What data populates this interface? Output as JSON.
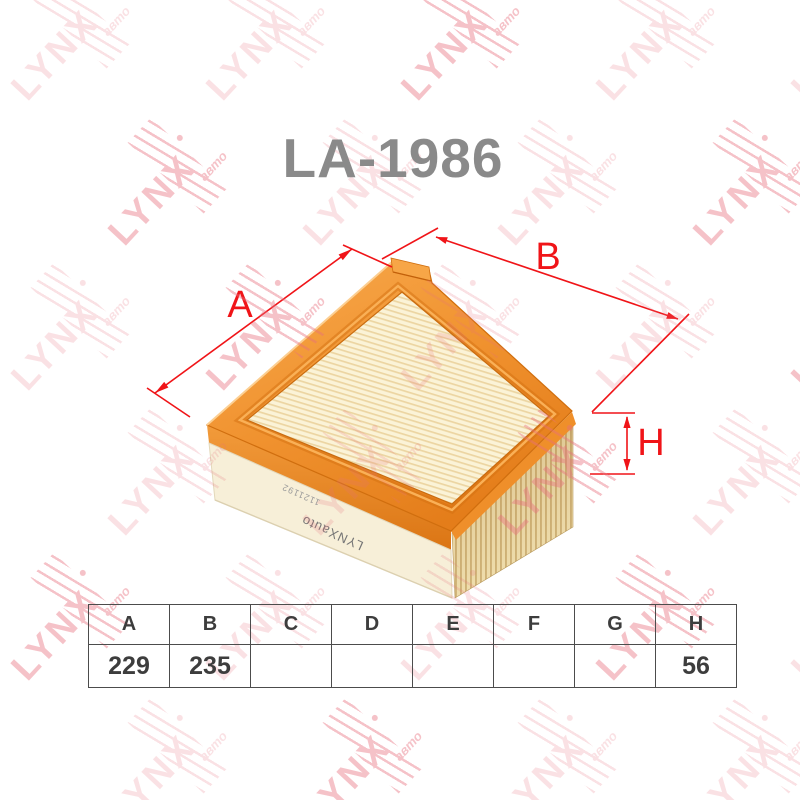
{
  "page": {
    "background": "#ffffff"
  },
  "title": {
    "text": "LA-1986",
    "color": "#8a8a8a"
  },
  "watermark": {
    "text": "LYNX",
    "sub": "авто",
    "color": "#e8707e"
  },
  "product": {
    "description": "engine air filter, orange frame with pleated paper media",
    "frame_color": "#f0922f",
    "media_color": "#fbf3d7",
    "stamp_brand": "LYNXauto",
    "stamp_code": "1121192"
  },
  "dimensions": {
    "color": "#f01418",
    "labels": {
      "a": "A",
      "b": "B",
      "h": "H"
    }
  },
  "table": {
    "headers": [
      "A",
      "B",
      "C",
      "D",
      "E",
      "F",
      "G",
      "H"
    ],
    "values": [
      "229",
      "235",
      "",
      "",
      "",
      "",
      "",
      "56"
    ]
  }
}
